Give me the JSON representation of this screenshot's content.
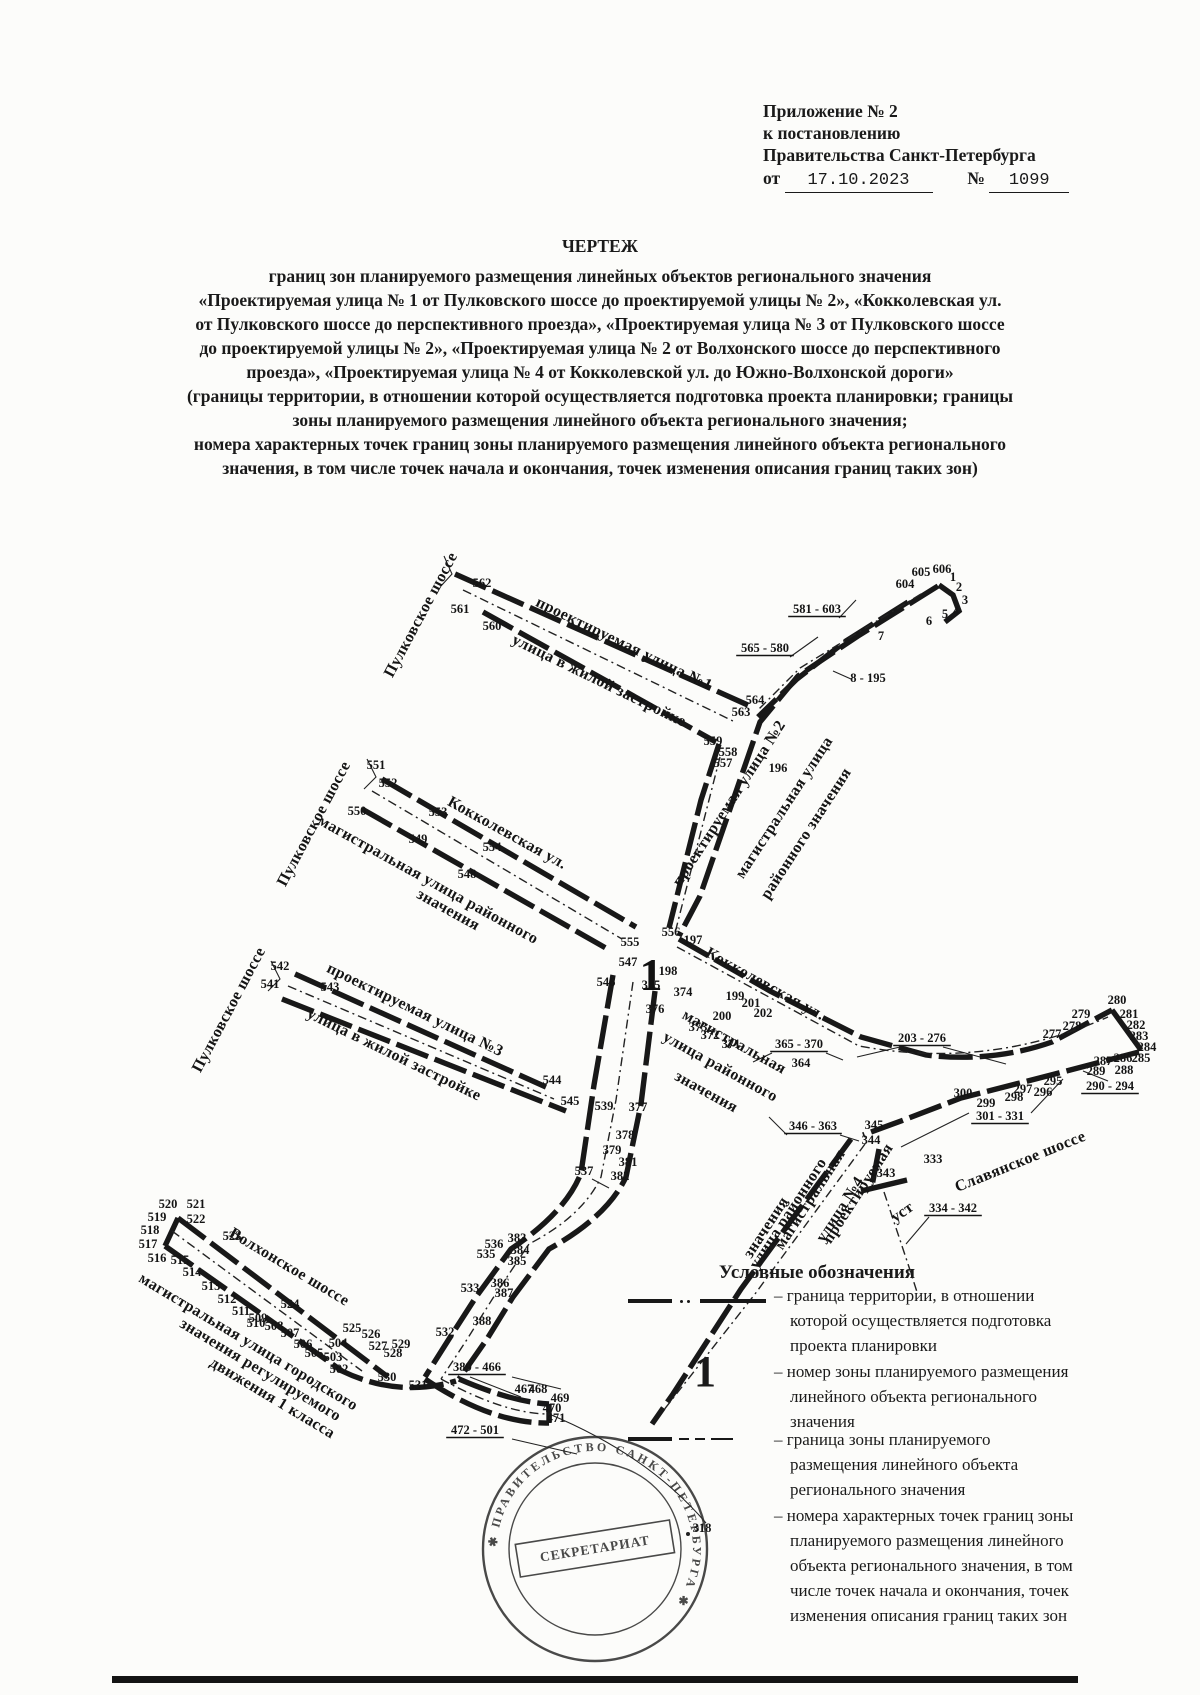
{
  "ink": "#1a1a1a",
  "paper": "#fcfcfa",
  "header": {
    "lines": [
      "Приложение № 2",
      "к постановлению",
      "Правительства Санкт-Петербурга"
    ],
    "date_prefix": "от",
    "date_value": "17.10.2023",
    "number_sign": "№",
    "number_value": "1099"
  },
  "title": {
    "heading": "ЧЕРТЕЖ",
    "lines": [
      "границ зон планируемого размещения линейных объектов регионального значения",
      "«Проектируемая улица № 1 от Пулковского шоссе до проектируемой улицы № 2», «Кокколевская ул.",
      "от Пулковского шоссе до перспективного проезда», «Проектируемая улица № 3 от Пулковского шоссе",
      "до проектируемой улицы № 2», «Проектируемая улица № 2 от Волхонского шоссе до перспективного",
      "проезда», «Проектируемая улица № 4 от Кокколевской ул. до Южно-Волхонской дороги»",
      "(границы территории, в отношении которой осуществляется подготовка проекта планировки; границы",
      "зоны планируемого размещения линейного объекта регионального значения;",
      "номера характерных точек границ зоны планируемого размещения линейного объекта регионального",
      "значения,  в том числе точек начала и окончания, точек изменения описания границ таких зон)"
    ]
  },
  "legend": {
    "title": "Условные обозначения",
    "items": [
      {
        "symbol": "territory-line",
        "lines": [
          "граница территории, в отношении",
          "которой осуществляется подготовка",
          "проекта планировки"
        ]
      },
      {
        "symbol": "zone-number",
        "symbol_text": "1",
        "lines": [
          "номер зоны планируемого размещения",
          "линейного объекта регионального",
          "значения"
        ]
      },
      {
        "symbol": "zone-line",
        "lines": [
          "граница зоны планируемого",
          "размещения линейного объекта",
          "регионального значения"
        ]
      },
      {
        "symbol": "point-numbers",
        "lines": [
          "номера характерных точек границ зоны",
          "планируемого размещения линейного",
          "объекта регионального значения, в том",
          "числе точек начала и окончания, точек",
          "изменения описания границ таких зон"
        ]
      }
    ]
  },
  "map": {
    "zone_number": {
      "t": "1",
      "x": 651,
      "y": 990
    },
    "stamp": {
      "ring_text": "✱ ПРАВИТЕЛЬСТВО САНКТ-ПЕТЕРБУРГА ✱",
      "band_text": "СЕКРЕТАРИАТ"
    },
    "street_labels": [
      {
        "t": "Пулковское шоссе",
        "x": 425,
        "y": 617,
        "r": -62
      },
      {
        "t": "проектируемая улица №1",
        "x": 622,
        "y": 648,
        "r": 26
      },
      {
        "t": "улица в жилой застройке",
        "x": 597,
        "y": 685,
        "r": 26
      },
      {
        "t": "Пулковское шоссе",
        "x": 318,
        "y": 826,
        "r": -62
      },
      {
        "t": "Кокколевская ул.",
        "x": 505,
        "y": 837,
        "r": 29
      },
      {
        "t": "магистральная улица районного",
        "x": 426,
        "y": 884,
        "r": 29
      },
      {
        "t": "значения",
        "x": 446,
        "y": 914,
        "r": 29
      },
      {
        "t": "проектируемая улица №2",
        "x": 733,
        "y": 806,
        "r": -57
      },
      {
        "t": "магистральная улица",
        "x": 788,
        "y": 810,
        "r": -57
      },
      {
        "t": "районного значения",
        "x": 810,
        "y": 836,
        "r": -57
      },
      {
        "t": "Пулковское шоссе",
        "x": 233,
        "y": 1012,
        "r": -62
      },
      {
        "t": "проектируемая улица №3",
        "x": 413,
        "y": 1014,
        "r": 26
      },
      {
        "t": "улица в жилой застройке",
        "x": 392,
        "y": 1059,
        "r": 26
      },
      {
        "t": "Кокколевская ул.",
        "x": 763,
        "y": 988,
        "r": 29
      },
      {
        "t": "магистральная",
        "x": 732,
        "y": 1046,
        "r": 29
      },
      {
        "t": "улица районного",
        "x": 718,
        "y": 1071,
        "r": 29
      },
      {
        "t": "значения",
        "x": 704,
        "y": 1096,
        "r": 29
      },
      {
        "t": "магистральная",
        "x": 814,
        "y": 1202,
        "r": -57
      },
      {
        "t": "улица районного",
        "x": 792,
        "y": 1216,
        "r": -57
      },
      {
        "t": "значения",
        "x": 770,
        "y": 1230,
        "r": -57
      },
      {
        "t": "проектируемая",
        "x": 862,
        "y": 1196,
        "r": -57
      },
      {
        "t": "улица №4",
        "x": 844,
        "y": 1212,
        "r": -57
      },
      {
        "t": "Волхонское шоссе",
        "x": 287,
        "y": 1271,
        "r": 31
      },
      {
        "t": "магистральная улица городского",
        "x": 246,
        "y": 1346,
        "r": 31
      },
      {
        "t": "значения регулируемого",
        "x": 258,
        "y": 1374,
        "r": 31
      },
      {
        "t": "движения 1 класса",
        "x": 270,
        "y": 1402,
        "r": 31
      },
      {
        "t": "Славянское шоссе",
        "x": 1022,
        "y": 1166,
        "r": -22
      },
      {
        "t": "уст",
        "x": 905,
        "y": 1216,
        "r": -35,
        "s": 13
      }
    ],
    "points": [
      {
        "t": "562",
        "x": 482,
        "y": 587
      },
      {
        "t": "561",
        "x": 460,
        "y": 613
      },
      {
        "t": "560",
        "x": 492,
        "y": 630
      },
      {
        "t": "565 - 580",
        "x": 765,
        "y": 652,
        "u": true
      },
      {
        "t": "581 - 603",
        "x": 817,
        "y": 613,
        "u": true
      },
      {
        "t": "604",
        "x": 905,
        "y": 588
      },
      {
        "t": "605",
        "x": 921,
        "y": 576
      },
      {
        "t": "606",
        "x": 942,
        "y": 573
      },
      {
        "t": "1",
        "x": 953,
        "y": 581
      },
      {
        "t": "2",
        "x": 959,
        "y": 591
      },
      {
        "t": "3",
        "x": 965,
        "y": 604
      },
      {
        "t": "4",
        "x": 956,
        "y": 615
      },
      {
        "t": "5",
        "x": 945,
        "y": 618
      },
      {
        "t": "6",
        "x": 929,
        "y": 625
      },
      {
        "t": "7",
        "x": 881,
        "y": 640
      },
      {
        "t": "8 - 195",
        "x": 868,
        "y": 682
      },
      {
        "t": "564",
        "x": 755,
        "y": 704
      },
      {
        "t": "563",
        "x": 741,
        "y": 716
      },
      {
        "t": "559",
        "x": 713,
        "y": 745
      },
      {
        "t": "558",
        "x": 728,
        "y": 756
      },
      {
        "t": "557",
        "x": 723,
        "y": 767
      },
      {
        "t": "196",
        "x": 778,
        "y": 772
      },
      {
        "t": "551",
        "x": 376,
        "y": 769
      },
      {
        "t": "552",
        "x": 388,
        "y": 787
      },
      {
        "t": "550",
        "x": 357,
        "y": 815
      },
      {
        "t": "553",
        "x": 438,
        "y": 816
      },
      {
        "t": "549",
        "x": 418,
        "y": 843
      },
      {
        "t": "554",
        "x": 492,
        "y": 851
      },
      {
        "t": "548",
        "x": 467,
        "y": 878
      },
      {
        "t": "555",
        "x": 630,
        "y": 946
      },
      {
        "t": "556",
        "x": 671,
        "y": 936
      },
      {
        "t": "197",
        "x": 693,
        "y": 944
      },
      {
        "t": "547",
        "x": 628,
        "y": 966
      },
      {
        "t": "198",
        "x": 668,
        "y": 975
      },
      {
        "t": "546",
        "x": 606,
        "y": 986
      },
      {
        "t": "375",
        "x": 651,
        "y": 989
      },
      {
        "t": "374",
        "x": 683,
        "y": 996
      },
      {
        "t": "376",
        "x": 655,
        "y": 1013
      },
      {
        "t": "373",
        "x": 698,
        "y": 1031
      },
      {
        "t": "372",
        "x": 710,
        "y": 1039
      },
      {
        "t": "371",
        "x": 731,
        "y": 1048
      },
      {
        "t": "199",
        "x": 735,
        "y": 1000
      },
      {
        "t": "201",
        "x": 751,
        "y": 1007
      },
      {
        "t": "200",
        "x": 722,
        "y": 1020
      },
      {
        "t": "202",
        "x": 763,
        "y": 1017
      },
      {
        "t": "365 - 370",
        "x": 799,
        "y": 1048,
        "u": true
      },
      {
        "t": "364",
        "x": 801,
        "y": 1067
      },
      {
        "t": "203 - 276",
        "x": 922,
        "y": 1042,
        "u": true
      },
      {
        "t": "277",
        "x": 1052,
        "y": 1038
      },
      {
        "t": "278",
        "x": 1072,
        "y": 1030
      },
      {
        "t": "279",
        "x": 1081,
        "y": 1018
      },
      {
        "t": "280",
        "x": 1117,
        "y": 1004
      },
      {
        "t": "281",
        "x": 1129,
        "y": 1018
      },
      {
        "t": "282",
        "x": 1136,
        "y": 1029
      },
      {
        "t": "283",
        "x": 1139,
        "y": 1040
      },
      {
        "t": "284",
        "x": 1147,
        "y": 1051
      },
      {
        "t": "285",
        "x": 1141,
        "y": 1062
      },
      {
        "t": "286",
        "x": 1123,
        "y": 1062
      },
      {
        "t": "287",
        "x": 1103,
        "y": 1065
      },
      {
        "t": "288",
        "x": 1124,
        "y": 1074
      },
      {
        "t": "289",
        "x": 1096,
        "y": 1075
      },
      {
        "t": "290 - 294",
        "x": 1110,
        "y": 1090,
        "u": true
      },
      {
        "t": "295",
        "x": 1053,
        "y": 1085
      },
      {
        "t": "296",
        "x": 1043,
        "y": 1096
      },
      {
        "t": "297",
        "x": 1023,
        "y": 1093
      },
      {
        "t": "298",
        "x": 1014,
        "y": 1101
      },
      {
        "t": "299",
        "x": 986,
        "y": 1107
      },
      {
        "t": "300",
        "x": 963,
        "y": 1097
      },
      {
        "t": "301 - 331",
        "x": 1000,
        "y": 1120,
        "u": true
      },
      {
        "t": "346 - 363",
        "x": 813,
        "y": 1130,
        "u": true
      },
      {
        "t": "345",
        "x": 874,
        "y": 1129
      },
      {
        "t": "344",
        "x": 871,
        "y": 1144
      },
      {
        "t": "343",
        "x": 886,
        "y": 1177
      },
      {
        "t": "333",
        "x": 933,
        "y": 1163
      },
      {
        "t": "334 - 342",
        "x": 953,
        "y": 1212,
        "u": true
      },
      {
        "t": "539",
        "x": 604,
        "y": 1110
      },
      {
        "t": "377",
        "x": 638,
        "y": 1111
      },
      {
        "t": "378",
        "x": 625,
        "y": 1139
      },
      {
        "t": "379",
        "x": 612,
        "y": 1154
      },
      {
        "t": "381",
        "x": 628,
        "y": 1166
      },
      {
        "t": "382",
        "x": 620,
        "y": 1180
      },
      {
        "t": "537",
        "x": 584,
        "y": 1175
      },
      {
        "t": "536",
        "x": 494,
        "y": 1248
      },
      {
        "t": "535",
        "x": 486,
        "y": 1258
      },
      {
        "t": "383",
        "x": 517,
        "y": 1242
      },
      {
        "t": "384",
        "x": 520,
        "y": 1254
      },
      {
        "t": "385",
        "x": 517,
        "y": 1265
      },
      {
        "t": "386",
        "x": 500,
        "y": 1287
      },
      {
        "t": "387",
        "x": 504,
        "y": 1297
      },
      {
        "t": "533",
        "x": 470,
        "y": 1292
      },
      {
        "t": "388",
        "x": 482,
        "y": 1325
      },
      {
        "t": "532",
        "x": 445,
        "y": 1336
      },
      {
        "t": "542",
        "x": 280,
        "y": 970
      },
      {
        "t": "541",
        "x": 270,
        "y": 988
      },
      {
        "t": "543",
        "x": 330,
        "y": 991
      },
      {
        "t": "544",
        "x": 552,
        "y": 1084
      },
      {
        "t": "545",
        "x": 570,
        "y": 1105
      },
      {
        "t": "520",
        "x": 168,
        "y": 1208
      },
      {
        "t": "521",
        "x": 196,
        "y": 1208
      },
      {
        "t": "519",
        "x": 157,
        "y": 1221
      },
      {
        "t": "522",
        "x": 196,
        "y": 1223
      },
      {
        "t": "518",
        "x": 150,
        "y": 1234
      },
      {
        "t": "517",
        "x": 148,
        "y": 1248
      },
      {
        "t": "516",
        "x": 157,
        "y": 1262
      },
      {
        "t": "515",
        "x": 180,
        "y": 1264
      },
      {
        "t": "514",
        "x": 192,
        "y": 1276
      },
      {
        "t": "513",
        "x": 211,
        "y": 1290
      },
      {
        "t": "512",
        "x": 227,
        "y": 1303
      },
      {
        "t": "511",
        "x": 241,
        "y": 1315
      },
      {
        "t": "510",
        "x": 256,
        "y": 1327
      },
      {
        "t": "523",
        "x": 232,
        "y": 1240
      },
      {
        "t": "524",
        "x": 290,
        "y": 1308
      },
      {
        "t": "509",
        "x": 258,
        "y": 1322
      },
      {
        "t": "508",
        "x": 274,
        "y": 1330
      },
      {
        "t": "507",
        "x": 290,
        "y": 1337
      },
      {
        "t": "506",
        "x": 303,
        "y": 1348
      },
      {
        "t": "505",
        "x": 314,
        "y": 1357
      },
      {
        "t": "504",
        "x": 338,
        "y": 1347
      },
      {
        "t": "503",
        "x": 333,
        "y": 1361
      },
      {
        "t": "502",
        "x": 339,
        "y": 1373
      },
      {
        "t": "525",
        "x": 352,
        "y": 1332
      },
      {
        "t": "526",
        "x": 371,
        "y": 1338
      },
      {
        "t": "527",
        "x": 378,
        "y": 1350
      },
      {
        "t": "529",
        "x": 401,
        "y": 1348
      },
      {
        "t": "528",
        "x": 393,
        "y": 1357
      },
      {
        "t": "530",
        "x": 387,
        "y": 1381
      },
      {
        "t": "531",
        "x": 418,
        "y": 1389
      },
      {
        "t": "389 - 466",
        "x": 477,
        "y": 1371,
        "u": true
      },
      {
        "t": "467",
        "x": 524,
        "y": 1393
      },
      {
        "t": "468",
        "x": 538,
        "y": 1393
      },
      {
        "t": "469",
        "x": 560,
        "y": 1402
      },
      {
        "t": "470",
        "x": 552,
        "y": 1412
      },
      {
        "t": "471",
        "x": 556,
        "y": 1422
      },
      {
        "t": "472 - 501",
        "x": 475,
        "y": 1434,
        "u": true
      },
      {
        "t": "318",
        "x": 702,
        "y": 1532
      }
    ]
  }
}
